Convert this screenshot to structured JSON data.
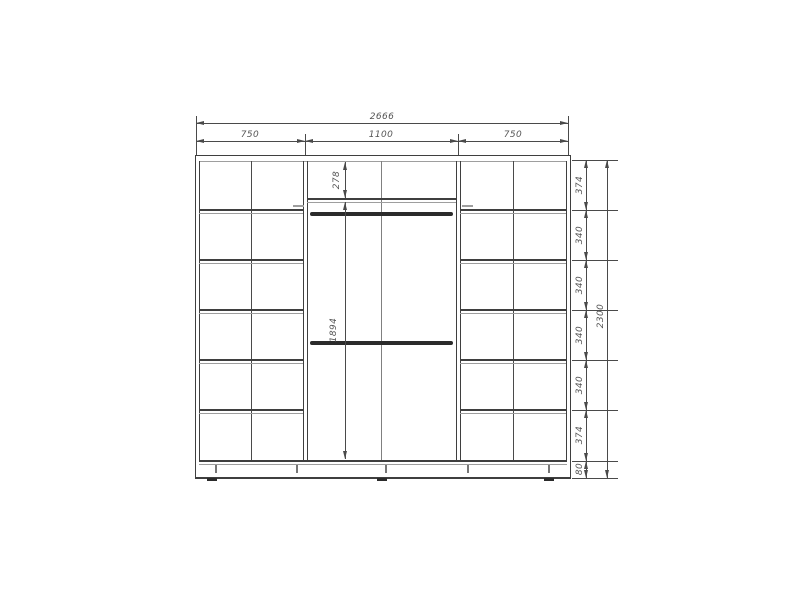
{
  "drawing": {
    "overall_width": "2666",
    "section_widths": [
      "750",
      "1100",
      "750"
    ],
    "overall_height": "2300",
    "height_segments": [
      "374",
      "340",
      "340",
      "340",
      "340",
      "374",
      "80"
    ],
    "top_shelf_depth": "278",
    "hanging_height": "1894",
    "colors": {
      "line_dark": "#3f3f3f",
      "line_light": "#9e9e9e",
      "dimension": "#4a4a4a",
      "label_text": "#555555",
      "background": "#ffffff"
    }
  }
}
